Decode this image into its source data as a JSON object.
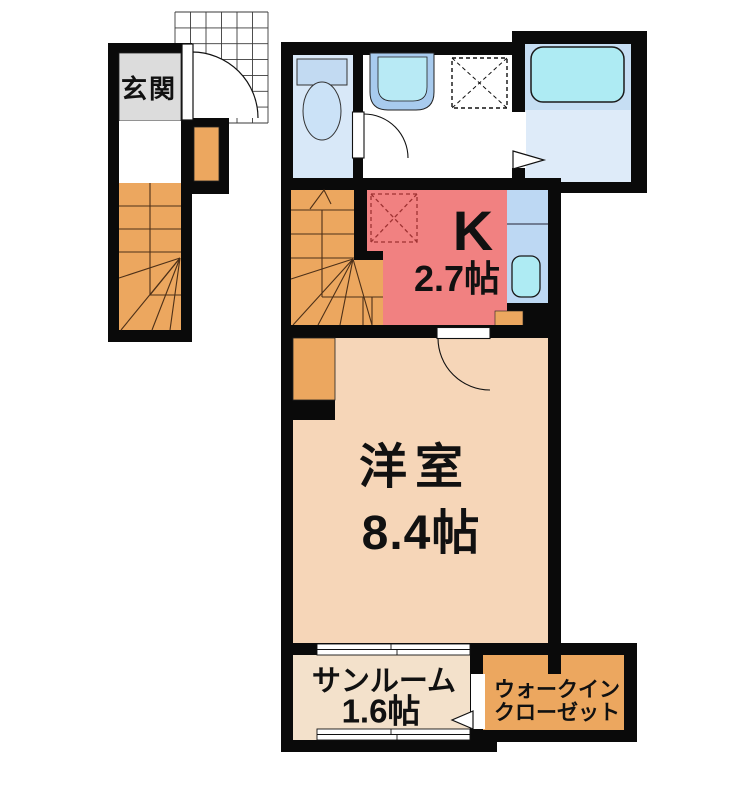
{
  "plan_title": "apartment-floor-plan",
  "rooms": {
    "genkan": {
      "label": "玄関"
    },
    "kitchen": {
      "label": "K",
      "size": "2.7帖"
    },
    "western_room": {
      "label": "洋室",
      "size": "8.4帖"
    },
    "sunroom": {
      "label": "サンルーム",
      "size": "1.6帖"
    },
    "walk_in_closet": {
      "label_line1": "ウォークイン",
      "label_line2": "クローゼット"
    }
  },
  "colors": {
    "wall": "#0a0a0a",
    "genkan_floor": "#dcdcdc",
    "stairs_orange": "#eca75f",
    "kitchen_red": "#f18181",
    "western_room_peach": "#f6d6b8",
    "sunroom_tan": "#f3e1cb",
    "closet_orange": "#eca75f",
    "toilet_room_blue": "#d8e8f8",
    "bathroom_upper_blue": "#c6def3",
    "bathroom_lower_blue": "#deebf9",
    "fixture_cyan": "#aeebf3",
    "counter_blue": "#bdd8f3",
    "fridge_dash_red": "#9e3232"
  },
  "fixtures": {
    "toilet": "toilet-icon",
    "washbasin": "sink-icon",
    "washer_pan": "washer-pan-icon",
    "bathtub": "bathtub-icon",
    "kitchen_sink": "kitchen-sink-icon",
    "fridge_space": "fridge-pan-icon",
    "entry_tile_grid": "tile-grid-icon",
    "door_swings": "door-swing-icon",
    "folding_doors": "folding-door-icon",
    "sliding_windows": "sliding-window-icon",
    "staircases": "stairs-icon"
  }
}
